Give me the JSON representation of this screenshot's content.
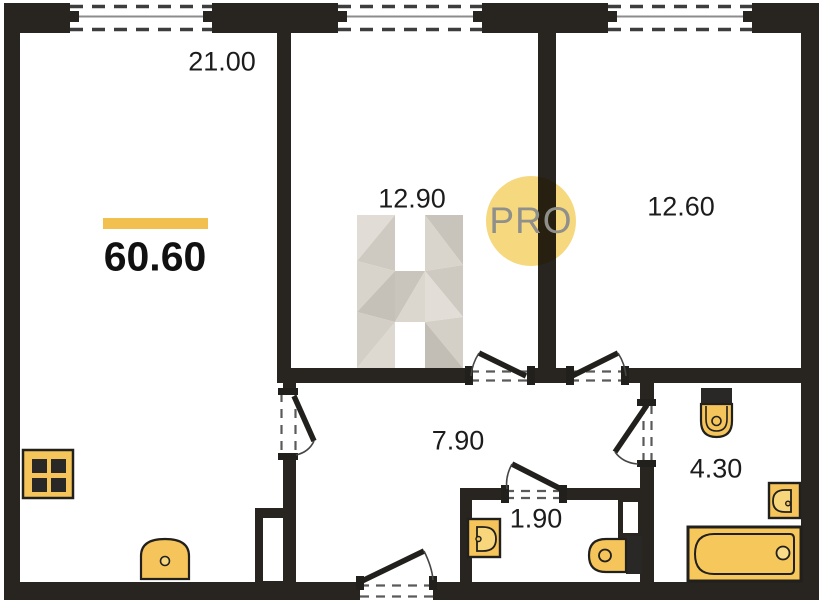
{
  "plan": {
    "type": "apartment-floor-plan",
    "total_area": "60.60",
    "labels": {
      "total": "60.60",
      "living": "21.00",
      "room2": "12.90",
      "room3": "12.60",
      "hallway": "7.90",
      "wc": "1.90",
      "bathroom": "4.30"
    },
    "rooms": [
      {
        "name": "living-kitchen",
        "area": "21.00"
      },
      {
        "name": "bedroom-1",
        "area": "12.90"
      },
      {
        "name": "bedroom-2",
        "area": "12.60"
      },
      {
        "name": "hallway",
        "area": "7.90"
      },
      {
        "name": "wc",
        "area": "1.90"
      },
      {
        "name": "bathroom",
        "area": "4.30"
      }
    ],
    "watermark": {
      "badge_text": "PRO",
      "logo_letter": "H"
    },
    "fixtures": [
      "stove",
      "kitchen-sink",
      "wc-sink",
      "wc-toilet",
      "bathroom-toilet",
      "bathroom-sink",
      "bathtub"
    ],
    "windows_count": 3,
    "doors_count": 6,
    "colors": {
      "wall": "#282521",
      "fixture_fill": "#f5c45a",
      "accent_bar": "#f2c04e",
      "pro_circle": "#f6d87e",
      "pro_text": "#8f8f8c",
      "label_text": "#1c1c1c"
    }
  }
}
